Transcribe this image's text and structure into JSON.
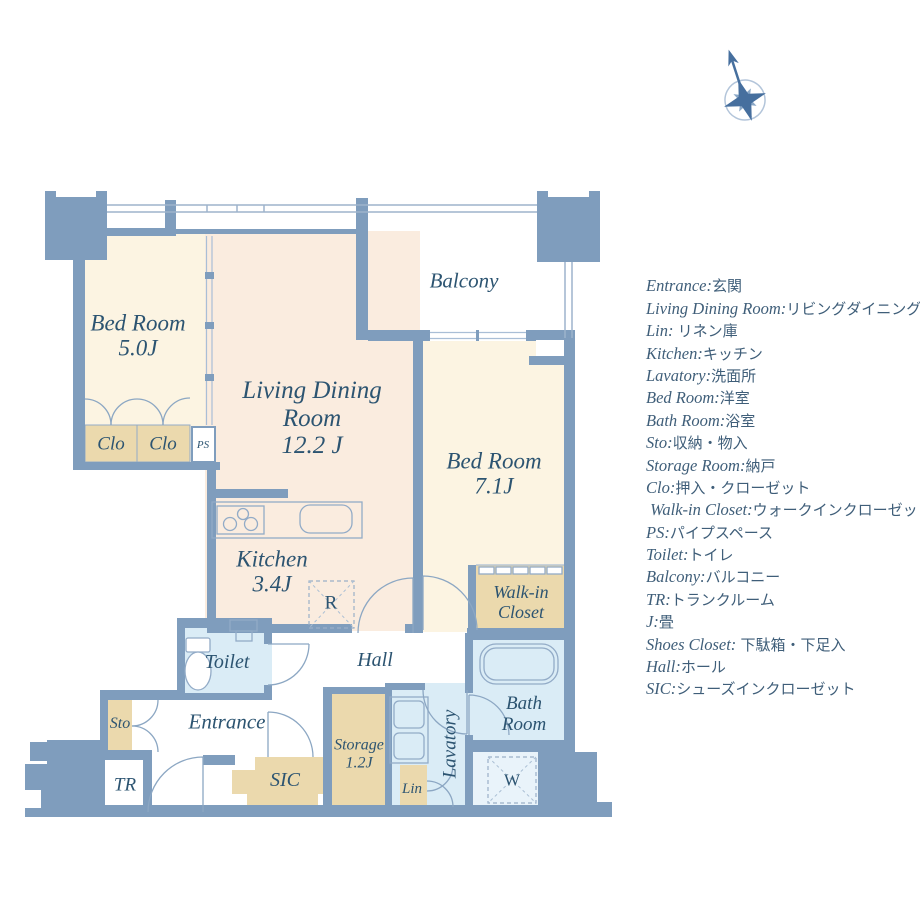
{
  "colors": {
    "wall": "#7f9dbd",
    "room_label_ink": "#2c5471",
    "legend_ink": "#3f5e79",
    "bedroom_fill": "#fcf4e2",
    "living_fill": "#faecdf",
    "closet_fill": "#ebd9ad",
    "wet_area_fill": "#daecf6",
    "washer_area_fill": "#e9f3fa"
  },
  "rooms": {
    "bedroom5": {
      "line1": "Bed Room",
      "line2": "5.0J"
    },
    "living": {
      "line1": "Living Dining",
      "line2": "Room",
      "line3": "12.2 J"
    },
    "balcony": {
      "label": "Balcony"
    },
    "bedroom7": {
      "line1": "Bed Room",
      "line2": "7.1J"
    },
    "kitchen": {
      "line1": "Kitchen",
      "line2": "3.4J"
    },
    "clo1": "Clo",
    "clo2": "Clo",
    "ps": "PS",
    "refrigerator": "R",
    "toilet": "Toilet",
    "hall": "Hall",
    "walkin": {
      "line1": "Walk-in",
      "line2": "Closet"
    },
    "bath": {
      "line1": "Bath",
      "line2": "Room"
    },
    "sto": "Sto",
    "entrance": "Entrance",
    "tr": "TR",
    "sic": "SIC",
    "storage": {
      "line1": "Storage",
      "line2": "1.2J"
    },
    "lin": "Lin",
    "lavatory": "Lavatory",
    "washer": "W"
  },
  "legend": {
    "items": [
      {
        "en": "Entrance:",
        "jp": "玄関"
      },
      {
        "en": "Living Dining Room:",
        "jp": "リビングダイニング"
      },
      {
        "en": "Lin:",
        "jp": " リネン庫"
      },
      {
        "en": "Kitchen:",
        "jp": "キッチン"
      },
      {
        "en": "Lavatory:",
        "jp": "洗面所"
      },
      {
        "en": "Bed Room:",
        "jp": "洋室"
      },
      {
        "en": "Bath Room:",
        "jp": "浴室"
      },
      {
        "en": "Sto:",
        "jp": "収納・物入"
      },
      {
        "en": "Storage Room:",
        "jp": "納戸"
      },
      {
        "en": "Clo:",
        "jp": "押入・クローゼット"
      },
      {
        "en": " Walk-in Closet:",
        "jp": "ウォークインクローゼット"
      },
      {
        "en": "PS:",
        "jp": "パイプスペース"
      },
      {
        "en": "Toilet:",
        "jp": "トイレ"
      },
      {
        "en": "Balcony:",
        "jp": "バルコニー"
      },
      {
        "en": "TR:",
        "jp": "トランクルーム"
      },
      {
        "en": "J:",
        "jp": "畳"
      },
      {
        "en": "Shoes Closet:",
        "jp": " 下駄箱・下足入"
      },
      {
        "en": "Hall:",
        "jp": "ホール"
      },
      {
        "en": "SIC:",
        "jp": "シューズインクローゼット"
      }
    ]
  }
}
